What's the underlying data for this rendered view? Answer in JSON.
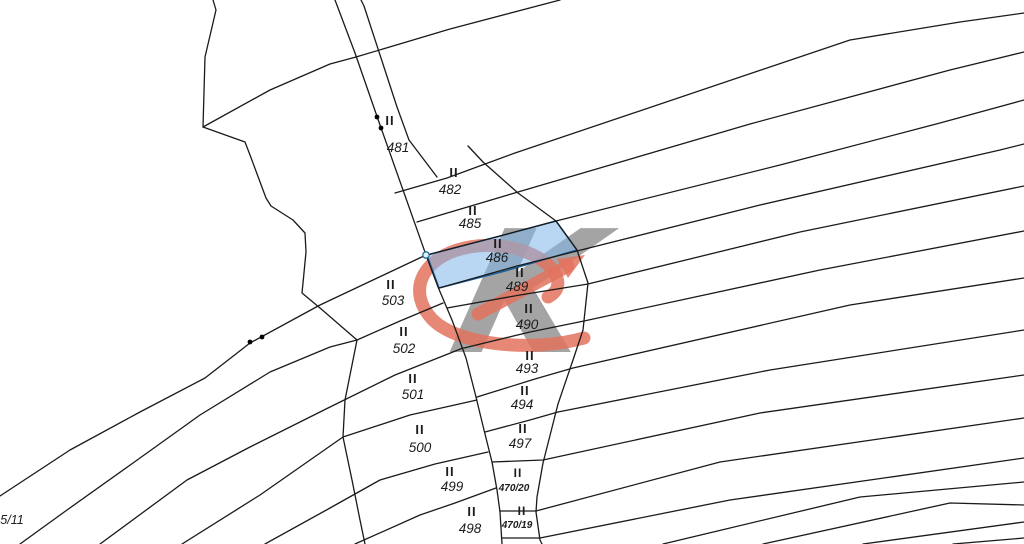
{
  "app": {
    "title": "Cadastral map viewer",
    "background": "#ffffff",
    "canvas": {
      "width": 1024,
      "height": 544
    }
  },
  "map": {
    "line_color": "#1a1a1a",
    "line_width": 1.3,
    "label_color": "#1c1c1c",
    "marker_glyph": "II",
    "highlight": {
      "parcel_id": "486",
      "fill": "#7fb7e8",
      "fill_opacity": 0.55,
      "stroke": "#1e5f9b",
      "polygon": [
        [
          427,
          255
        ],
        [
          500,
          236
        ],
        [
          556,
          221
        ],
        [
          577,
          250
        ],
        [
          505,
          271
        ],
        [
          439,
          288
        ]
      ]
    },
    "watermark": {
      "gray": "#8b8b8b",
      "red": "#e3735f",
      "k_glyph": "K",
      "k_size": 170,
      "k_x": 446,
      "k_y": 352,
      "k_skew": -14,
      "k_opacity": 0.78,
      "loop_path": "M 584 338 C 534 352 458 346 432 319 C 408 293 420 262 457 250 C 496 238 541 251 554 272 C 561 283 558 292 548 297",
      "shaft": [
        [
          478,
          314
        ],
        [
          568,
          266
        ]
      ],
      "head": [
        [
          585,
          255
        ],
        [
          557,
          259
        ],
        [
          568,
          278
        ]
      ],
      "red_width": 13,
      "red_opacity": 0.85
    },
    "markers": {
      "dots": [
        [
          377,
          117
        ],
        [
          381,
          128
        ],
        [
          250,
          342
        ],
        [
          262,
          337
        ]
      ],
      "dot_radius": 2.4,
      "vertex_circle": {
        "cx": 426,
        "cy": 255,
        "r": 3.2,
        "fill": "#e8f4fb",
        "stroke": "#1f6f9f"
      }
    },
    "lines": [
      {
        "name": "boundary-zigzag-upper",
        "pts": [
          [
            213,
            0
          ],
          [
            216,
            10
          ],
          [
            205,
            57
          ],
          [
            203,
            127
          ],
          [
            245,
            142
          ],
          [
            250,
            155
          ],
          [
            266,
            198
          ],
          [
            271,
            206
          ],
          [
            293,
            220
          ],
          [
            305,
            233
          ],
          [
            306,
            252
          ],
          [
            303,
            283
          ],
          [
            302,
            293
          ],
          [
            320,
            308
          ],
          [
            357,
            340
          ]
        ]
      },
      {
        "name": "boundary-zigzag-lower",
        "pts": [
          [
            357,
            340
          ],
          [
            345,
            400
          ],
          [
            343,
            437
          ],
          [
            352,
            480
          ],
          [
            360,
            520
          ],
          [
            365,
            544
          ]
        ]
      },
      {
        "name": "corridor-left",
        "pts": [
          [
            335,
            0
          ],
          [
            355,
            53
          ],
          [
            380,
            125
          ],
          [
            426,
            255
          ],
          [
            438,
            287
          ],
          [
            452,
            320
          ],
          [
            466,
            358
          ],
          [
            475,
            393
          ],
          [
            484,
            430
          ],
          [
            492,
            462
          ],
          [
            497,
            490
          ],
          [
            500,
            512
          ],
          [
            502,
            544
          ]
        ]
      },
      {
        "name": "corridor-right",
        "pts": [
          [
            361,
            0
          ],
          [
            364,
            6
          ],
          [
            397,
            107
          ],
          [
            409,
            140
          ],
          [
            437,
            177
          ]
        ]
      },
      {
        "name": "curve-503-top",
        "pts": [
          [
            0,
            496
          ],
          [
            70,
            450
          ],
          [
            140,
            412
          ],
          [
            205,
            378
          ],
          [
            250,
            343
          ],
          [
            320,
            305
          ],
          [
            426,
            255
          ]
        ]
      },
      {
        "name": "curve-503-502",
        "pts": [
          [
            20,
            544
          ],
          [
            67,
            510
          ],
          [
            133,
            463
          ],
          [
            200,
            415
          ],
          [
            270,
            372
          ],
          [
            330,
            347
          ],
          [
            357,
            340
          ],
          [
            400,
            321
          ],
          [
            443,
            303
          ]
        ]
      },
      {
        "name": "curve-502-501",
        "pts": [
          [
            100,
            544
          ],
          [
            187,
            480
          ],
          [
            250,
            447
          ],
          [
            330,
            407
          ],
          [
            395,
            375
          ],
          [
            463,
            348
          ]
        ]
      },
      {
        "name": "curve-501-500",
        "pts": [
          [
            182,
            544
          ],
          [
            260,
            495
          ],
          [
            343,
            437
          ],
          [
            410,
            415
          ],
          [
            477,
            400
          ]
        ]
      },
      {
        "name": "curve-500-499",
        "pts": [
          [
            265,
            544
          ],
          [
            330,
            508
          ],
          [
            380,
            480
          ],
          [
            435,
            464
          ],
          [
            488,
            452
          ]
        ]
      },
      {
        "name": "curve-499-498",
        "pts": [
          [
            355,
            544
          ],
          [
            420,
            515
          ],
          [
            455,
            503
          ],
          [
            496,
            488
          ]
        ]
      },
      {
        "name": "diagonal-1",
        "pts": [
          [
            203,
            127
          ],
          [
            270,
            90
          ],
          [
            330,
            64
          ],
          [
            356,
            57
          ],
          [
            450,
            29
          ],
          [
            560,
            0
          ]
        ]
      },
      {
        "name": "diagonal-2",
        "pts": [
          [
            395,
            193
          ],
          [
            447,
            178
          ],
          [
            515,
            153
          ],
          [
            850,
            40
          ],
          [
            960,
            22
          ],
          [
            1024,
            13
          ]
        ]
      },
      {
        "name": "diagonal-3",
        "pts": [
          [
            417,
            222
          ],
          [
            518,
            192
          ],
          [
            750,
            124
          ],
          [
            950,
            70
          ],
          [
            1024,
            52
          ]
        ]
      },
      {
        "name": "diagonal-4",
        "pts": [
          [
            427,
            255
          ],
          [
            500,
            236
          ],
          [
            556,
            221
          ],
          [
            780,
            165
          ],
          [
            940,
            123
          ],
          [
            1024,
            100
          ]
        ]
      },
      {
        "name": "diagonal-5",
        "pts": [
          [
            439,
            288
          ],
          [
            517,
            266
          ],
          [
            577,
            251
          ],
          [
            760,
            205
          ],
          [
            1000,
            150
          ],
          [
            1024,
            144
          ]
        ]
      },
      {
        "name": "diagonal-6",
        "pts": [
          [
            447,
            308
          ],
          [
            520,
            295
          ],
          [
            588,
            284
          ],
          [
            800,
            232
          ],
          [
            1024,
            186
          ]
        ]
      },
      {
        "name": "diagonal-7",
        "pts": [
          [
            464,
            348
          ],
          [
            530,
            332
          ],
          [
            584,
            321
          ],
          [
            820,
            270
          ],
          [
            1024,
            231
          ]
        ]
      },
      {
        "name": "diagonal-8",
        "pts": [
          [
            477,
            397
          ],
          [
            535,
            379
          ],
          [
            573,
            368
          ],
          [
            850,
            305
          ],
          [
            1024,
            278
          ]
        ]
      },
      {
        "name": "diagonal-9",
        "pts": [
          [
            485,
            432
          ],
          [
            530,
            420
          ],
          [
            558,
            412
          ],
          [
            770,
            370
          ],
          [
            1024,
            330
          ]
        ]
      },
      {
        "name": "diagonal-10",
        "pts": [
          [
            492,
            462
          ],
          [
            543,
            460
          ],
          [
            760,
            413
          ],
          [
            1024,
            375
          ]
        ]
      },
      {
        "name": "diagonal-11",
        "pts": [
          [
            500,
            511
          ],
          [
            536,
            511
          ],
          [
            720,
            462
          ],
          [
            1024,
            418
          ]
        ]
      },
      {
        "name": "diagonal-12",
        "pts": [
          [
            502,
            538
          ],
          [
            540,
            538
          ],
          [
            730,
            500
          ],
          [
            1024,
            458
          ]
        ]
      },
      {
        "name": "fan-right-boundary",
        "pts": [
          [
            468,
            146
          ],
          [
            483,
            162
          ],
          [
            518,
            193
          ],
          [
            556,
            221
          ],
          [
            577,
            250
          ],
          [
            588,
            283
          ],
          [
            583,
            330
          ],
          [
            573,
            360
          ],
          [
            558,
            404
          ],
          [
            543,
            463
          ],
          [
            537,
            497
          ],
          [
            536,
            512
          ],
          [
            540,
            540
          ],
          [
            542,
            544
          ]
        ]
      },
      {
        "name": "bottom-strip-1",
        "pts": [
          [
            663,
            544
          ],
          [
            860,
            497
          ],
          [
            1024,
            482
          ]
        ]
      },
      {
        "name": "bottom-strip-2",
        "pts": [
          [
            763,
            544
          ],
          [
            950,
            503
          ],
          [
            1024,
            505
          ]
        ]
      },
      {
        "name": "bottom-strip-3",
        "pts": [
          [
            863,
            544
          ],
          [
            1024,
            522
          ]
        ]
      },
      {
        "name": "bottom-strip-4",
        "pts": [
          [
            953,
            544
          ],
          [
            1024,
            538
          ]
        ]
      }
    ],
    "parcels": [
      {
        "id": "481",
        "marker": [
          390,
          125
        ],
        "label": [
          398,
          152
        ],
        "small": false,
        "highlighted": false
      },
      {
        "id": "482",
        "marker": [
          454,
          177
        ],
        "label": [
          450,
          194
        ],
        "small": false,
        "highlighted": false
      },
      {
        "id": "485",
        "marker": [
          473,
          215
        ],
        "label": [
          470,
          228
        ],
        "small": false,
        "highlighted": false
      },
      {
        "id": "486",
        "marker": [
          498,
          248
        ],
        "label": [
          497,
          262
        ],
        "small": false,
        "highlighted": true
      },
      {
        "id": "489",
        "marker": [
          520,
          277
        ],
        "label": [
          517,
          291
        ],
        "small": false,
        "highlighted": false
      },
      {
        "id": "490",
        "marker": [
          529,
          313
        ],
        "label": [
          527,
          329
        ],
        "small": false,
        "highlighted": false
      },
      {
        "id": "493",
        "marker": [
          530,
          360
        ],
        "label": [
          527,
          373
        ],
        "small": false,
        "highlighted": false
      },
      {
        "id": "494",
        "marker": [
          525,
          395
        ],
        "label": [
          522,
          409
        ],
        "small": false,
        "highlighted": false
      },
      {
        "id": "497",
        "marker": [
          523,
          433
        ],
        "label": [
          520,
          448
        ],
        "small": false,
        "highlighted": false
      },
      {
        "id": "470/20",
        "marker": [
          518,
          477
        ],
        "label": [
          514,
          491
        ],
        "small": true,
        "highlighted": false
      },
      {
        "id": "470/19",
        "marker": [
          522,
          515
        ],
        "label": [
          517,
          528
        ],
        "small": true,
        "highlighted": false
      },
      {
        "id": "499",
        "marker": [
          450,
          476
        ],
        "label": [
          452,
          491
        ],
        "small": false,
        "highlighted": false
      },
      {
        "id": "498",
        "marker": [
          472,
          516
        ],
        "label": [
          470,
          533
        ],
        "small": false,
        "highlighted": false
      },
      {
        "id": "500",
        "marker": [
          420,
          434
        ],
        "label": [
          420,
          452
        ],
        "small": false,
        "highlighted": false
      },
      {
        "id": "501",
        "marker": [
          413,
          383
        ],
        "label": [
          413,
          399
        ],
        "small": false,
        "highlighted": false
      },
      {
        "id": "502",
        "marker": [
          404,
          336
        ],
        "label": [
          404,
          353
        ],
        "small": false,
        "highlighted": false
      },
      {
        "id": "503",
        "marker": [
          391,
          289
        ],
        "label": [
          393,
          305
        ],
        "small": false,
        "highlighted": false
      }
    ],
    "edge_labels": [
      {
        "text": "5/11",
        "x": 12,
        "y": 524
      }
    ]
  }
}
